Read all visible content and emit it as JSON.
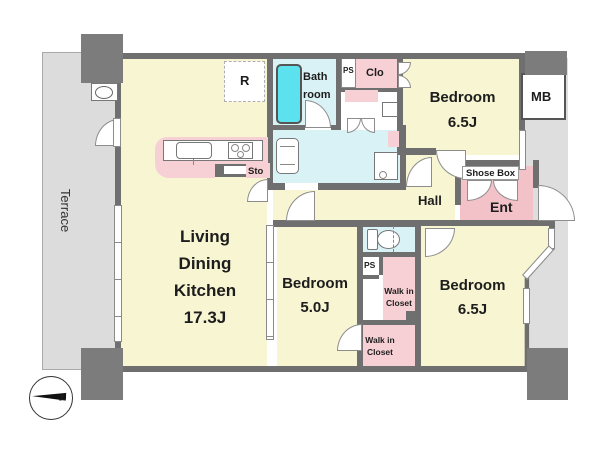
{
  "title": "Apartment floor plan",
  "colors": {
    "floor_yellow": "#f7f5d2",
    "sanitary_cyan": "#d9f2f5",
    "closet_pink": "#f6d0d4",
    "entrance_pink": "#f3c2c9",
    "bathtub_cyan": "#5ce2ee",
    "wall_gray": "#6f6f6f",
    "terrace_gray": "#dcdcdc",
    "corridor_gray": "#dedede"
  },
  "labels": {
    "terrace": "Terrace",
    "refrigerator": "R",
    "bath_line1": "Bath",
    "bath_line2": "room",
    "ps": "PS",
    "clo": "Clo",
    "mb": "MB",
    "sto": "Sto",
    "shose_box": "Shose Box",
    "ent": "Ent",
    "hall": "Hall",
    "north": "N"
  },
  "rooms": {
    "ldk": {
      "l1": "Living",
      "l2": "Dining",
      "l3": "Kitchen",
      "size": "17.3J"
    },
    "bedroom_ne": {
      "name": "Bedroom",
      "size": "6.5J"
    },
    "bedroom_sw": {
      "name": "Bedroom",
      "size": "5.0J"
    },
    "bedroom_se": {
      "name": "Bedroom",
      "size": "6.5J"
    },
    "wic": {
      "l1": "Walk in",
      "l2": "Closet"
    }
  }
}
